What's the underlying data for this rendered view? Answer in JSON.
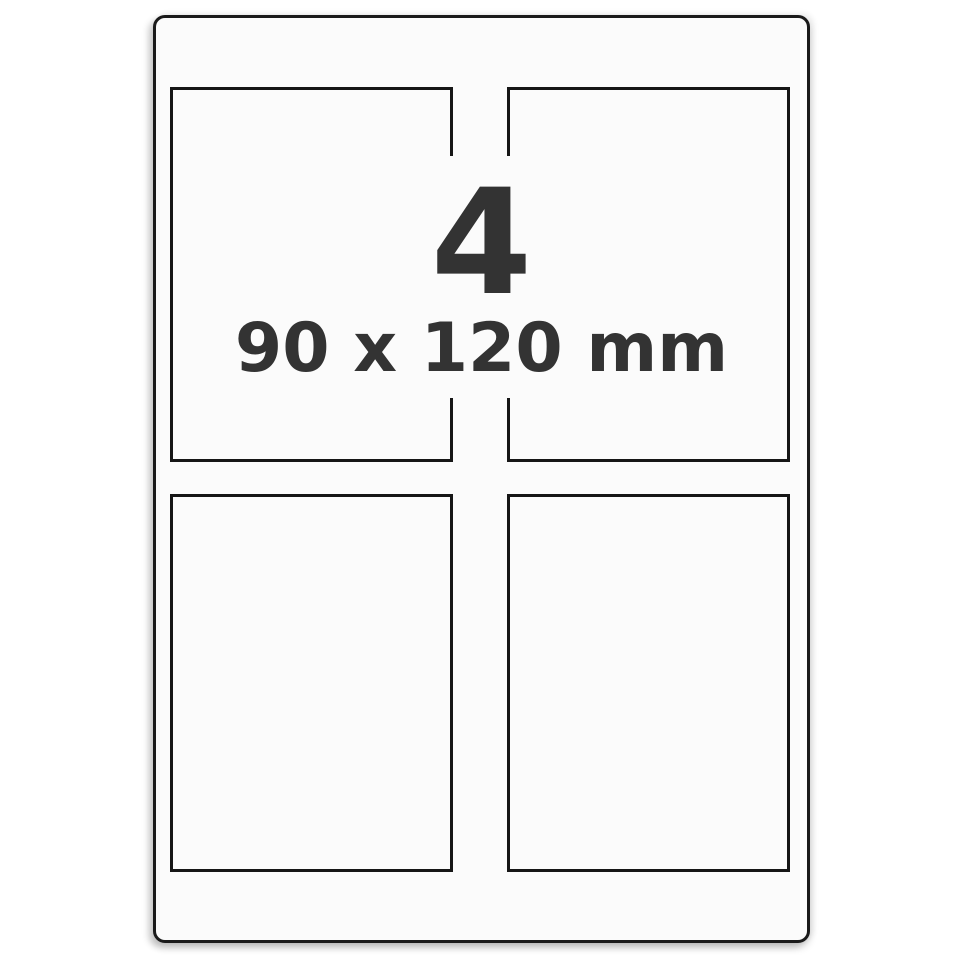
{
  "sheet": {
    "labels_per_sheet": "4",
    "label_dimensions": "90 x 120 mm",
    "grid": {
      "rows": 2,
      "columns": 2
    }
  },
  "colors": {
    "text": "#333333",
    "sheet_border": "#1a1a1a",
    "label_border": "#161616",
    "sheet_background": "#fbfbfb",
    "page_background": "#ffffff"
  }
}
